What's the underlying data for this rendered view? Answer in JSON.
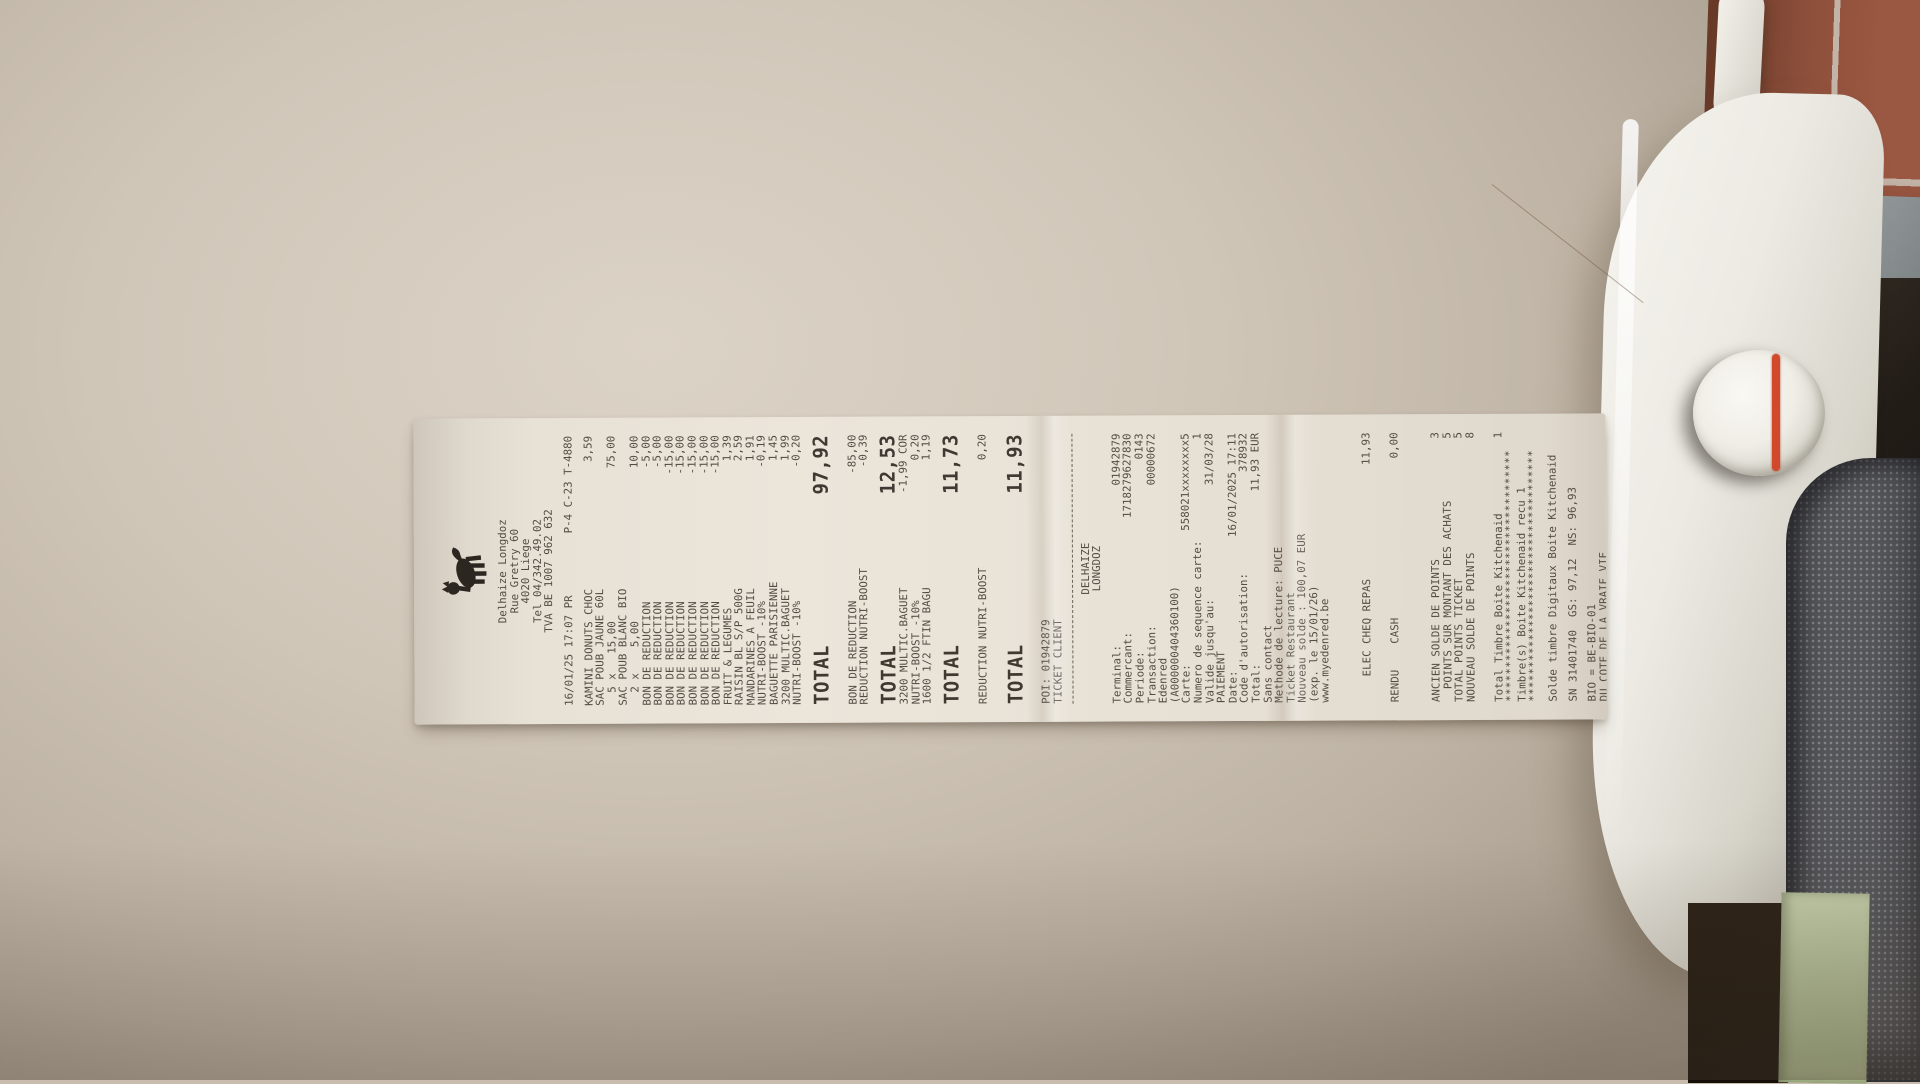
{
  "colors": {
    "paper": "#e7e1d6",
    "ink": "#47413a",
    "ink_strong": "#332d26",
    "tile": "#9a5741",
    "tile_grout": "#c4b4a8",
    "tile_gray": "#9aa0a2",
    "appliance": "#eceae3",
    "knob_stripe": "#d2482a",
    "fabric": "#55565a",
    "fabric_dot": "#85868b",
    "floor_green": "#c6d0ac",
    "white_object": "#f3f1ea"
  },
  "receipt": {
    "logo": "delhaize-lion",
    "lines": [
      {
        "t": "center",
        "l": "Delhaize Longdoz"
      },
      {
        "t": "center",
        "l": "Rue Gretry 60"
      },
      {
        "t": "center",
        "l": "4020 Liege"
      },
      {
        "t": "center",
        "l": "Tel 04/342.49.02"
      },
      {
        "t": "center",
        "l": "TVA BE 1007 962 632"
      },
      {
        "t": "gap"
      },
      {
        "t": "row",
        "l": "16/01/25 17:07 PR",
        "r": "P-4 C-23 T-4880"
      },
      {
        "t": "gap"
      },
      {
        "t": "row",
        "l": "KAMINI DONUTS CHOC",
        "r": "3,59"
      },
      {
        "t": "left",
        "l": "SAC POUB JAUNE 60L"
      },
      {
        "t": "row",
        "l": "  5 x   15,00",
        "r": "75,00"
      },
      {
        "t": "left",
        "l": "SAC POUB BLANC BIO"
      },
      {
        "t": "row",
        "l": "  2 x    5,00",
        "r": "10,00"
      },
      {
        "t": "row",
        "l": "BON DE REDUCTION",
        "r": "-5,00"
      },
      {
        "t": "row",
        "l": "BON DE REDUCTION",
        "r": "-5,00"
      },
      {
        "t": "row",
        "l": "BON DE REDUCTION",
        "r": "-15,00"
      },
      {
        "t": "row",
        "l": "BON DE REDUCTION",
        "r": "-15,00"
      },
      {
        "t": "row",
        "l": "BON DE REDUCTION",
        "r": "-15,00"
      },
      {
        "t": "row",
        "l": "BON DE REDUCTION",
        "r": "-15,00"
      },
      {
        "t": "row",
        "l": "BON DE REDUCTION",
        "r": "-15,00"
      },
      {
        "t": "row",
        "l": "FRUIT & LEGUMES",
        "r": "1,39"
      },
      {
        "t": "row",
        "l": "RAISIN BL S/P 500G",
        "r": "2,59"
      },
      {
        "t": "row",
        "l": "MANDARINES A FEUIL",
        "r": "1,91"
      },
      {
        "t": "row",
        "l": "NUTRI-BOOST -10%",
        "r": "-0,19"
      },
      {
        "t": "row",
        "l": "BAGUETTE PARISIENNE",
        "r": "1,45"
      },
      {
        "t": "row",
        "l": "3200 MULTIC.BAGUET",
        "r": "1,99"
      },
      {
        "t": "row",
        "l": "NUTRI-BOOST -10%",
        "r": "-0,20"
      },
      {
        "t": "total",
        "l": "TOTAL",
        "r": "97,92"
      },
      {
        "t": "gap2"
      },
      {
        "t": "row",
        "l": "BON DE REDUCTION",
        "r": "-85,00"
      },
      {
        "t": "row",
        "l": "REDUCTION NUTRI-BOOST",
        "r": "-0,39"
      },
      {
        "t": "total",
        "l": "TOTAL",
        "r": "12,53"
      },
      {
        "t": "row",
        "l": "3200 MULTIC.BAGUET",
        "r": "-1,99 COR"
      },
      {
        "t": "row",
        "l": "NUTRI-BOOST -10%",
        "r": "0,20"
      },
      {
        "t": "row",
        "l": "1600 1/2 FTIN BAGU",
        "r": "1,19"
      },
      {
        "t": "total",
        "l": "TOTAL",
        "r": "11,73"
      },
      {
        "t": "gap2"
      },
      {
        "t": "row",
        "l": "REDUCTION NUTRI-BOOST",
        "r": "0,20"
      },
      {
        "t": "gap"
      },
      {
        "t": "total",
        "l": "TOTAL",
        "r": "11,93"
      },
      {
        "t": "gap2"
      },
      {
        "t": "left",
        "l": "POI: 01942879"
      },
      {
        "t": "left",
        "l": "TICKET CLIENT"
      },
      {
        "t": "dash"
      },
      {
        "t": "center",
        "l": "DELHAIZE"
      },
      {
        "t": "center",
        "l": "LONGDOZ"
      },
      {
        "t": "gap"
      },
      {
        "t": "row",
        "l": "Terminal:",
        "r": "01942879"
      },
      {
        "t": "row",
        "l": "Commercant:",
        "r": "1718279627830"
      },
      {
        "t": "row",
        "l": "Periode:",
        "r": "0143"
      },
      {
        "t": "row",
        "l": "Transaction:",
        "r": "00000672"
      },
      {
        "t": "left",
        "l": "Edenred"
      },
      {
        "t": "left",
        "l": "(A000000404360100)"
      },
      {
        "t": "row",
        "l": "Carte:",
        "r": "558021xxxxxxxx5"
      },
      {
        "t": "row",
        "l": "Numero de sequence carte:",
        "r": "1"
      },
      {
        "t": "row",
        "l": "Valide jusqu'au:",
        "r": "31/03/28"
      },
      {
        "t": "left",
        "l": "PAIEMENT"
      },
      {
        "t": "row",
        "l": "Date:",
        "r": "16/01/2025 17:11"
      },
      {
        "t": "row",
        "l": "Code d'autorisation:",
        "r": "378932"
      },
      {
        "t": "row",
        "l": "Total:",
        "r": "11,93 EUR"
      },
      {
        "t": "left",
        "l": "Sans contact"
      },
      {
        "t": "left",
        "l": "Methode de lecture: PUCE"
      },
      {
        "t": "left",
        "l": "Ticket Restaurant"
      },
      {
        "t": "left",
        "l": "Nouveau solde : 100,07 EUR"
      },
      {
        "t": "left",
        "l": "(exp. le 15/01/26)"
      },
      {
        "t": "left",
        "l": "www.myedenred.be"
      },
      {
        "t": "gap3"
      },
      {
        "t": "row",
        "l": "    ELEC CHEQ REPAS",
        "r": "11,93"
      },
      {
        "t": "gap2"
      },
      {
        "t": "row",
        "l": "RENDU    CASH",
        "r": "0,00"
      },
      {
        "t": "gap3"
      },
      {
        "t": "row",
        "l": "ANCIEN SOLDE DE POINTS",
        "r": "3"
      },
      {
        "t": "row",
        "l": "  POINTS SUR MONTANT DES ACHATS",
        "r": "5"
      },
      {
        "t": "row",
        "l": "TOTAL POINTS TICKET",
        "r": "5"
      },
      {
        "t": "row",
        "l": "NOUVEAU SOLDE DE POINTS",
        "r": "8"
      },
      {
        "t": "gap2"
      },
      {
        "t": "row",
        "l": "Total Timbre Boite Kitchenaid",
        "r": "1"
      },
      {
        "t": "stars",
        "l": "*************************************"
      },
      {
        "t": "left",
        "l": "Timbre(s) Boite Kitchenaid recu 1"
      },
      {
        "t": "stars",
        "l": "*************************************"
      },
      {
        "t": "gap"
      },
      {
        "t": "left",
        "l": "Solde timbre Digitaux Boite Kitchenaid"
      },
      {
        "t": "gap"
      },
      {
        "t": "left",
        "l": "SN 31401740  GS: 97,12  NS: 96,93"
      },
      {
        "t": "gap"
      },
      {
        "t": "left",
        "l": "BIO = BE-BIO-01"
      },
      {
        "t": "left",
        "l": "DU COTE DE LA VRAIE VIE"
      }
    ]
  }
}
